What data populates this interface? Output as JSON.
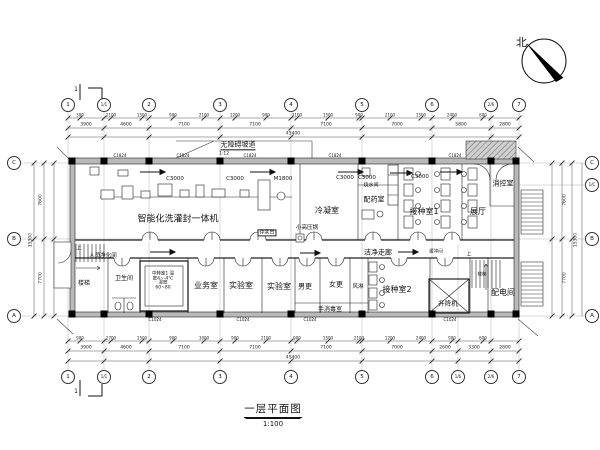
{
  "meta": {
    "title": "一层平面图",
    "scale": "1:100",
    "north": "北",
    "drawing_type": "architectural-floor-plan"
  },
  "axes": {
    "top": [
      [
        "1",
        68
      ],
      [
        "1/1",
        104
      ],
      [
        "2",
        149
      ],
      [
        "3",
        220
      ],
      [
        "4",
        291
      ],
      [
        "5",
        362
      ],
      [
        "6",
        432
      ],
      [
        "2/6",
        491
      ],
      [
        "7",
        519
      ]
    ],
    "bottom": [
      [
        "1",
        68
      ],
      [
        "1/1",
        104
      ],
      [
        "2",
        149
      ],
      [
        "3",
        220
      ],
      [
        "4",
        291
      ],
      [
        "5",
        362
      ],
      [
        "6",
        432
      ],
      [
        "1/6",
        458
      ],
      [
        "2/6",
        491
      ],
      [
        "7",
        519
      ]
    ],
    "left": [
      [
        "C",
        163
      ],
      [
        "B",
        239
      ],
      [
        "A",
        316
      ]
    ],
    "right": [
      [
        "C",
        163
      ],
      [
        "1/C",
        185
      ],
      [
        "B",
        239
      ],
      [
        "A",
        316
      ]
    ]
  },
  "columns": [
    72,
    104,
    149,
    220,
    291,
    362,
    432,
    491,
    516
  ],
  "labels": [
    {
      "t": "智能化洗灌封一体机",
      "x": 178,
      "y": 220,
      "s": 9,
      "n": "room-label-filling-line"
    },
    {
      "t": "冷凝室",
      "x": 327,
      "y": 211,
      "s": 8,
      "n": "room-label-condensing"
    },
    {
      "t": "配药室",
      "x": 374,
      "y": 200,
      "s": 7,
      "n": "room-label-dispensing"
    },
    {
      "t": "烧水间",
      "x": 371,
      "y": 186,
      "s": 5,
      "n": "room-label-boiler"
    },
    {
      "t": "接种室1",
      "x": 424,
      "y": 212,
      "s": 8,
      "n": "room-label-inoculation-1"
    },
    {
      "t": "展厅",
      "x": 478,
      "y": 212,
      "s": 8,
      "n": "room-label-exhibition"
    },
    {
      "t": "消控室",
      "x": 503,
      "y": 184,
      "s": 7,
      "n": "room-label-fire-control"
    },
    {
      "t": "洁净走廊",
      "x": 378,
      "y": 253,
      "s": 7,
      "n": "corridor-label"
    },
    {
      "t": "人员净化间",
      "x": 103,
      "y": 257,
      "s": 5.5,
      "n": "room-label-personnel-clean"
    },
    {
      "t": "楼梯",
      "x": 84,
      "y": 284,
      "s": 6,
      "n": "room-label-stair"
    },
    {
      "t": "卫生间",
      "x": 124,
      "y": 279,
      "s": 6,
      "n": "room-label-toilet"
    },
    {
      "t": "业务室",
      "x": 206,
      "y": 286,
      "s": 8,
      "n": "room-label-business"
    },
    {
      "t": "实验室",
      "x": 241,
      "y": 286,
      "s": 8,
      "n": "room-label-lab-1"
    },
    {
      "t": "实验室",
      "x": 279,
      "y": 287,
      "s": 8,
      "n": "room-label-lab-2"
    },
    {
      "t": "男更",
      "x": 305,
      "y": 287,
      "s": 7,
      "n": "room-label-men-change"
    },
    {
      "t": "女更",
      "x": 336,
      "y": 285,
      "s": 7,
      "n": "room-label-women-change"
    },
    {
      "t": "风淋",
      "x": 358,
      "y": 288,
      "s": 5.5,
      "n": "room-label-air-shower"
    },
    {
      "t": "接种室2",
      "x": 397,
      "y": 290,
      "s": 8,
      "n": "room-label-inoculation-2"
    },
    {
      "t": "升降机",
      "x": 448,
      "y": 304,
      "s": 6.5,
      "n": "room-label-lift"
    },
    {
      "t": "配电间",
      "x": 503,
      "y": 293,
      "s": 8,
      "n": "room-label-power"
    },
    {
      "t": "手消毒室",
      "x": 330,
      "y": 310,
      "s": 6,
      "n": "room-label-hand-disinfect"
    },
    {
      "t": "小高压锅",
      "x": 307,
      "y": 229,
      "s": 5.5,
      "n": "equip-label-autoclave"
    },
    {
      "t": "存浆台",
      "x": 267,
      "y": 233,
      "s": 5,
      "b": 1,
      "n": "equip-label-holding-table"
    },
    {
      "t": "缓冲间",
      "x": 436,
      "y": 253,
      "s": 4.5,
      "n": "room-label-buffer"
    },
    {
      "t": "上",
      "x": 469,
      "y": 255,
      "s": 5,
      "n": "stair-up-note"
    },
    {
      "t": "楼梯",
      "x": 482,
      "y": 276,
      "s": 4.5,
      "n": "stair-note"
    },
    {
      "t": "上",
      "x": 79,
      "y": 249,
      "s": 5,
      "n": "stair-up-note-left"
    },
    {
      "t": "无障碍坡道",
      "x": 238,
      "y": 146,
      "s": 7,
      "u": 1,
      "n": "ramp-label"
    },
    {
      "t": "1:12",
      "x": 224,
      "y": 155,
      "s": 4.5,
      "n": "ramp-slope"
    },
    {
      "t": "中转库1 温\n度4~-4℃\n湿度\n60~80",
      "x": 163,
      "y": 282,
      "s": 4.5,
      "p": 1,
      "n": "cold-store-note"
    },
    {
      "t": "C3000",
      "x": 175,
      "y": 180,
      "s": 5.5,
      "n": "window-tag"
    },
    {
      "t": "C3000",
      "x": 235,
      "y": 180,
      "s": 5.5,
      "n": "window-tag"
    },
    {
      "t": "M1800",
      "x": 283,
      "y": 180,
      "s": 5.5,
      "n": "door-tag"
    },
    {
      "t": "C3000",
      "x": 345,
      "y": 179,
      "s": 5.5,
      "n": "window-tag"
    },
    {
      "t": "C3000",
      "x": 367,
      "y": 179,
      "s": 5.5,
      "n": "window-tag"
    },
    {
      "t": "C3000",
      "x": 420,
      "y": 178,
      "s": 5.5,
      "n": "window-tag"
    },
    {
      "t": "C1824",
      "x": 120,
      "y": 156,
      "s": 4,
      "n": "window-tag-small"
    },
    {
      "t": "C1824",
      "x": 183,
      "y": 156,
      "s": 4,
      "n": "window-tag-small"
    },
    {
      "t": "C1824",
      "x": 250,
      "y": 156,
      "s": 4,
      "n": "window-tag-small"
    },
    {
      "t": "C1824",
      "x": 335,
      "y": 156,
      "s": 4,
      "n": "window-tag-small"
    },
    {
      "t": "C1824",
      "x": 455,
      "y": 156,
      "s": 4,
      "n": "window-tag-small"
    },
    {
      "t": "C1024",
      "x": 155,
      "y": 320,
      "s": 4,
      "n": "window-tag-small"
    },
    {
      "t": "C1024",
      "x": 243,
      "y": 320,
      "s": 4,
      "n": "window-tag-small"
    },
    {
      "t": "C1024",
      "x": 310,
      "y": 320,
      "s": 4,
      "n": "window-tag-small"
    },
    {
      "t": "C1024",
      "x": 450,
      "y": 320,
      "s": 4,
      "n": "window-tag-small"
    },
    {
      "t": "1",
      "x": 76,
      "y": 90,
      "s": 6,
      "n": "section-mark-number"
    },
    {
      "t": "1",
      "x": 76,
      "y": 392,
      "s": 6,
      "n": "section-mark-number"
    }
  ],
  "dims": {
    "detail_xs": [
      80,
      111,
      142,
      173,
      204,
      235,
      266,
      297,
      328,
      359,
      390,
      421,
      452,
      483
    ],
    "top_detail": [
      "300",
      "2100",
      "1500",
      "900",
      "2100",
      "1200",
      "900",
      "2100",
      "1500",
      "900",
      "2100",
      "1500",
      "2400",
      "600"
    ],
    "bottom_detail": [
      "900",
      "2700",
      "1500",
      "900",
      "3000",
      "900",
      "2100",
      "900",
      "1500",
      "2100",
      "1200",
      "2400",
      "900",
      "600"
    ],
    "top_bay": [
      [
        "3900",
        86
      ],
      [
        "4600",
        126
      ],
      [
        "7100",
        184
      ],
      [
        "7100",
        255
      ],
      [
        "7100",
        326
      ],
      [
        "7000",
        397
      ],
      [
        "5800",
        461
      ],
      [
        "2800",
        505
      ]
    ],
    "bottom_bay": [
      [
        "3900",
        86
      ],
      [
        "4600",
        126
      ],
      [
        "7100",
        184
      ],
      [
        "7100",
        255
      ],
      [
        "7100",
        326
      ],
      [
        "7000",
        397
      ],
      [
        "2600",
        445
      ],
      [
        "3300",
        474
      ],
      [
        "2800",
        505
      ]
    ],
    "top_total": [
      [
        "45400",
        293
      ]
    ],
    "bottom_total": [
      [
        "45400",
        293
      ]
    ],
    "left_bay": [
      [
        "7600",
        200
      ],
      [
        "7700",
        278
      ]
    ],
    "left_total": [
      [
        "15300",
        240
      ]
    ],
    "right_bay": [
      [
        "7600",
        200
      ],
      [
        "7700",
        278
      ]
    ],
    "right_total": [
      [
        "15300",
        240
      ]
    ]
  }
}
